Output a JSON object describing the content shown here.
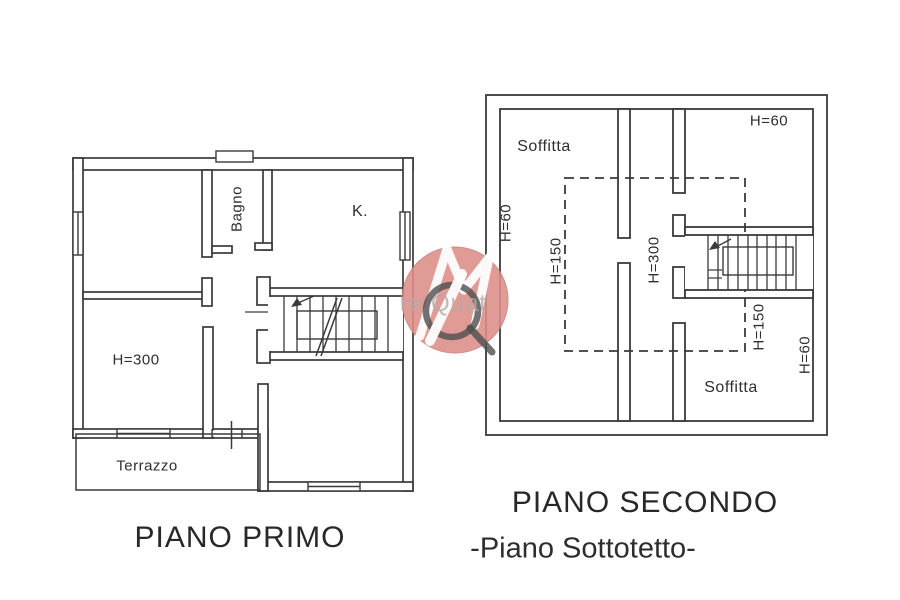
{
  "document_type": "cadastral floor plan drawing",
  "plans": {
    "primo": {
      "title": "PIANO PRIMO",
      "labels": {
        "bagno": "Bagno",
        "kitchen": "K.",
        "height": "H=300",
        "terrace": "Terrazzo"
      }
    },
    "secondo": {
      "title": "PIANO SECONDO",
      "subtitle": "-Piano Sottotetto-",
      "labels": {
        "soffitta_top": "Soffitta",
        "h60_top_right": "H=60",
        "h60_left": "H=60",
        "h150_left": "H=150",
        "h300_center": "H=300",
        "h150_right": "H=150",
        "h60_right": "H=60",
        "soffitta_bottom": "Soffitta"
      }
    }
  },
  "watermark": {
    "visible_text": "re Quat",
    "colors": {
      "circle": "#DE8E88",
      "mark": "#FFFFFF",
      "ring": "#4F4F4F",
      "text": "#B3ACA8"
    }
  },
  "drawing": {
    "line_color": "#3A3A3A",
    "background": "#FFFFFF"
  }
}
